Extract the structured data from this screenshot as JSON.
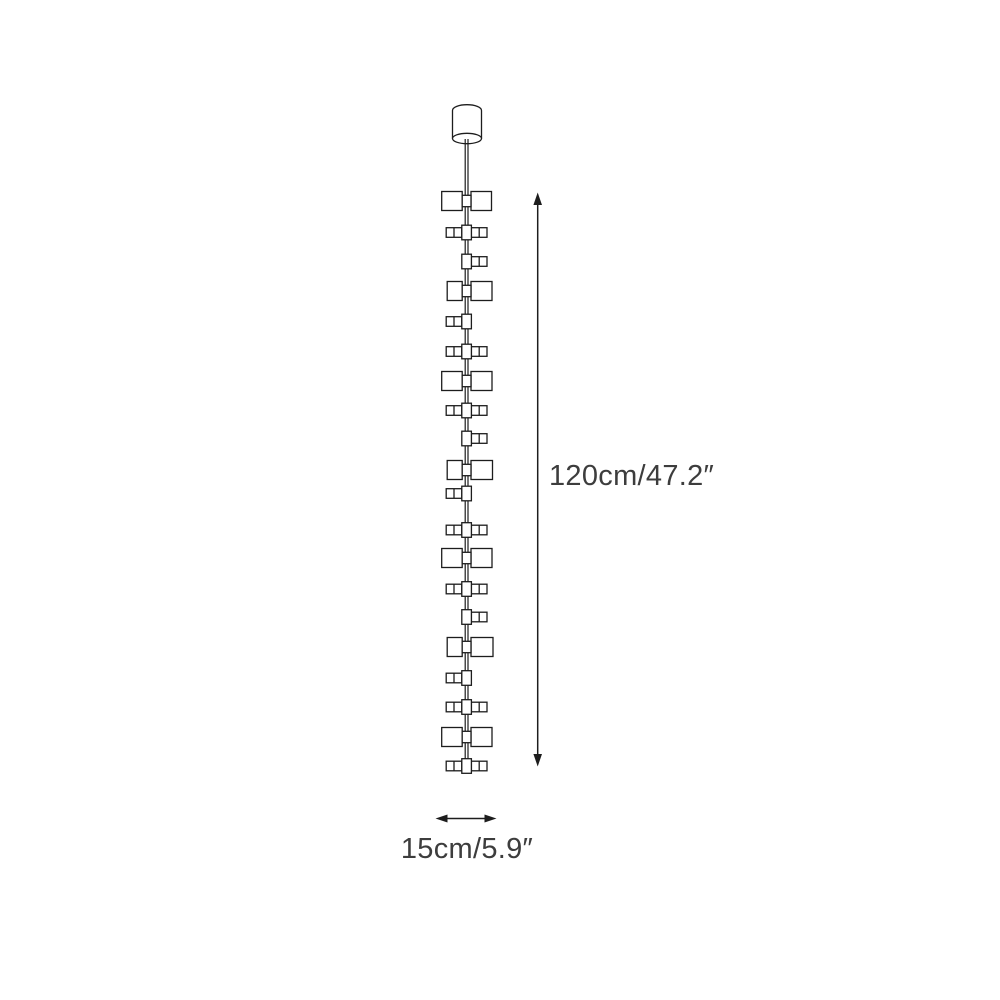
{
  "figure": {
    "kind": "product-dimension-diagram",
    "product": "multi-shade vertical pendant light",
    "colors": {
      "background": "#ffffff",
      "line": "#1d1d1d",
      "text": "#3d3d3d"
    },
    "labels": {
      "height": "120cm/47.2″",
      "width": "15cm/5.9″"
    },
    "fixture": {
      "canopy": {
        "shape": "cylinder"
      },
      "elements": [
        {
          "type": "shade",
          "y": 201,
          "left_w": 20.5,
          "right_w": 20.5
        },
        {
          "type": "connector",
          "y": 232.5,
          "sides": "both"
        },
        {
          "type": "connector",
          "y": 261.5,
          "sides": "right"
        },
        {
          "type": "shade",
          "y": 291,
          "left_w": 15,
          "right_w": 21
        },
        {
          "type": "connector",
          "y": 321.5,
          "sides": "left"
        },
        {
          "type": "connector",
          "y": 351.5,
          "sides": "both"
        },
        {
          "type": "shade",
          "y": 381,
          "left_w": 20.5,
          "right_w": 21
        },
        {
          "type": "connector",
          "y": 410.5,
          "sides": "both"
        },
        {
          "type": "connector",
          "y": 438.5,
          "sides": "right"
        },
        {
          "type": "shade",
          "y": 470,
          "left_w": 15,
          "right_w": 21.5
        },
        {
          "type": "connector",
          "y": 493.5,
          "sides": "left"
        },
        {
          "type": "connector",
          "y": 530,
          "sides": "both"
        },
        {
          "type": "shade",
          "y": 558,
          "left_w": 20.5,
          "right_w": 21
        },
        {
          "type": "connector",
          "y": 589,
          "sides": "both"
        },
        {
          "type": "connector",
          "y": 617,
          "sides": "right"
        },
        {
          "type": "shade",
          "y": 647,
          "left_w": 15,
          "right_w": 22
        },
        {
          "type": "connector",
          "y": 678,
          "sides": "left"
        },
        {
          "type": "connector",
          "y": 707,
          "sides": "both"
        },
        {
          "type": "shade",
          "y": 737,
          "left_w": 20.5,
          "right_w": 21
        },
        {
          "type": "connector",
          "y": 766,
          "sides": "both"
        }
      ]
    },
    "dimension_lines": {
      "height": {
        "orientation": "vertical"
      },
      "width": {
        "orientation": "horizontal"
      }
    }
  }
}
